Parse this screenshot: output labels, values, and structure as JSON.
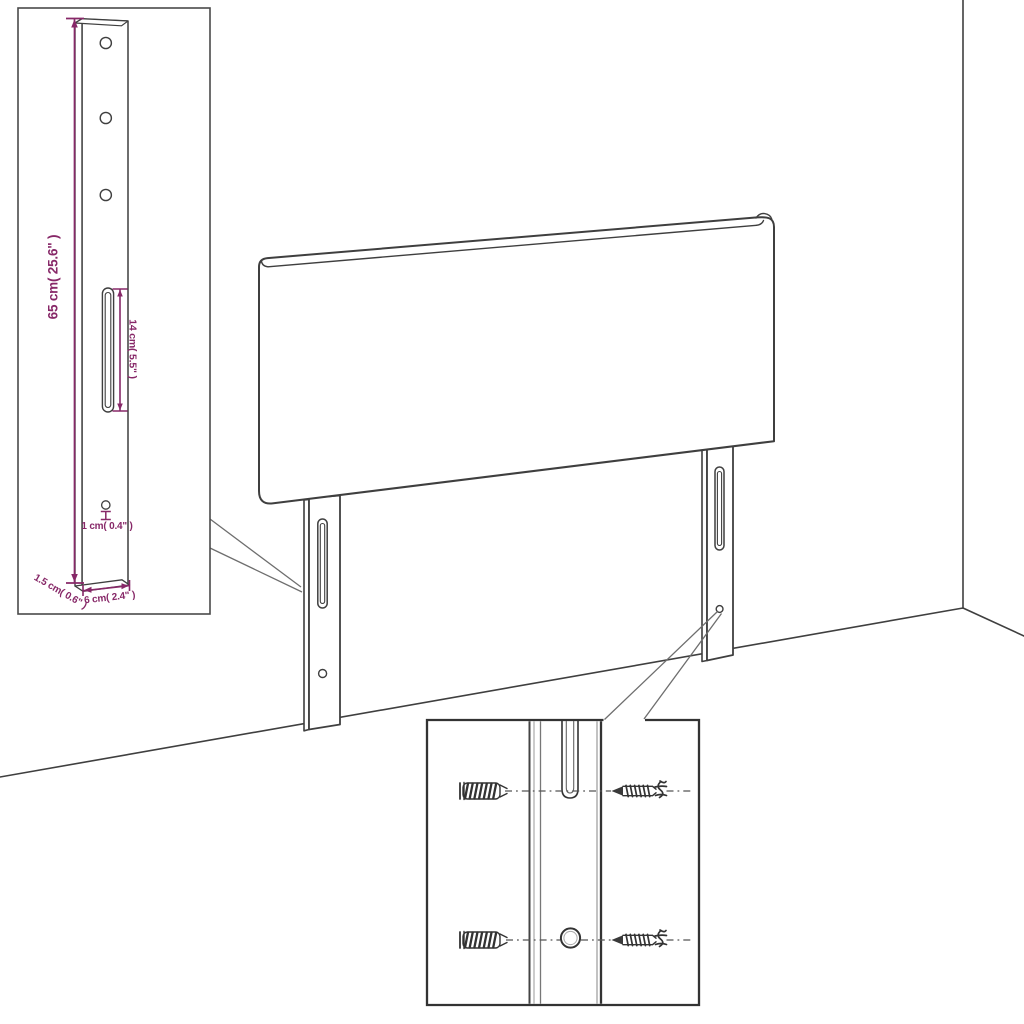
{
  "labels": {
    "leg_height": "65 cm( 25.6\" )",
    "slot_length": "14 cm( 5.5\" )",
    "hole_diameter": "1 cm( 0.4\" )",
    "leg_thickness": "1.5 cm( 0.6\" )",
    "leg_width": "6 cm( 2.4\" )"
  },
  "colors": {
    "dimension_annotation": "#872868",
    "line_art": "#3f3f3f",
    "background": "#ffffff"
  }
}
